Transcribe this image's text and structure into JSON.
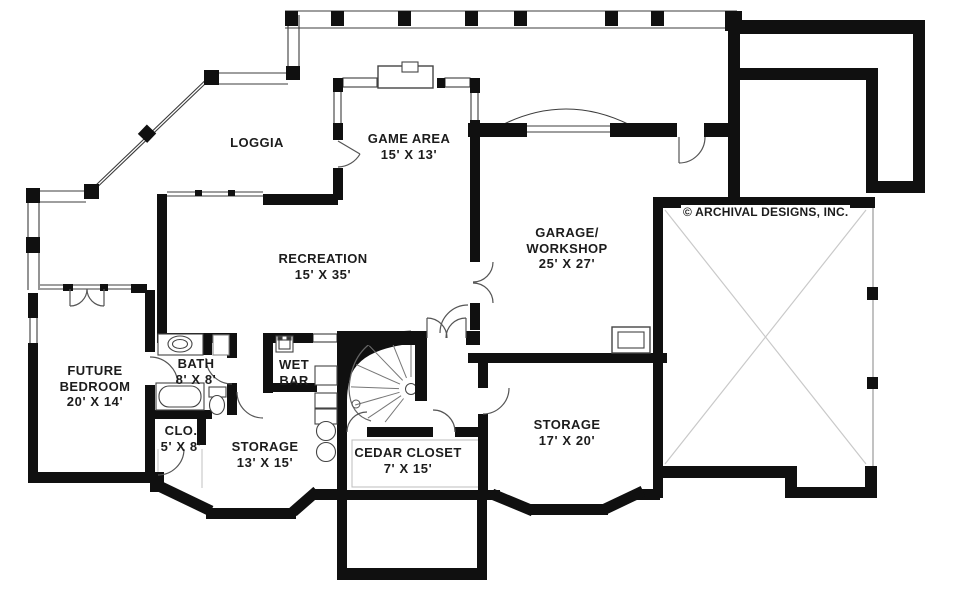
{
  "canvas": {
    "width": 960,
    "height": 597,
    "background": "#ffffff"
  },
  "colors": {
    "wall": "#101010",
    "porch_line": "#3c3c3c",
    "door_line": "#555555",
    "cross_line": "#c9c9c9",
    "label_text": "#1c1c1c"
  },
  "copyright": "© ARCHIVAL DESIGNS, INC.",
  "rooms": [
    {
      "id": "loggia",
      "lines": [
        "LOGGIA"
      ]
    },
    {
      "id": "game-area",
      "lines": [
        "GAME AREA",
        "15' X 13'"
      ]
    },
    {
      "id": "garage-workshop",
      "lines": [
        "GARAGE/",
        "WORKSHOP",
        "25' X 27'"
      ]
    },
    {
      "id": "recreation",
      "lines": [
        "RECREATION",
        "15' X 35'"
      ]
    },
    {
      "id": "future-bedroom",
      "lines": [
        "FUTURE",
        "BEDROOM",
        "20' X 14'"
      ]
    },
    {
      "id": "bath",
      "lines": [
        "BATH",
        "8' X 8'"
      ]
    },
    {
      "id": "wet-bar",
      "lines": [
        "WET",
        "BAR"
      ]
    },
    {
      "id": "closet",
      "lines": [
        "CLO.",
        "5' X 8'"
      ]
    },
    {
      "id": "storage-13",
      "lines": [
        "STORAGE",
        "13' X 15'"
      ]
    },
    {
      "id": "cedar-closet",
      "lines": [
        "CEDAR CLOSET",
        "7' X 15'"
      ]
    },
    {
      "id": "storage-17",
      "lines": [
        "STORAGE",
        "17' X 20'"
      ]
    }
  ],
  "fixtures": [
    "curved-staircase",
    "fireplace",
    "bathtub",
    "toilet",
    "vanity-sink",
    "bar-sink",
    "laundry-tubs",
    "garage-window",
    "deck-posts",
    "garage-door-arc"
  ]
}
